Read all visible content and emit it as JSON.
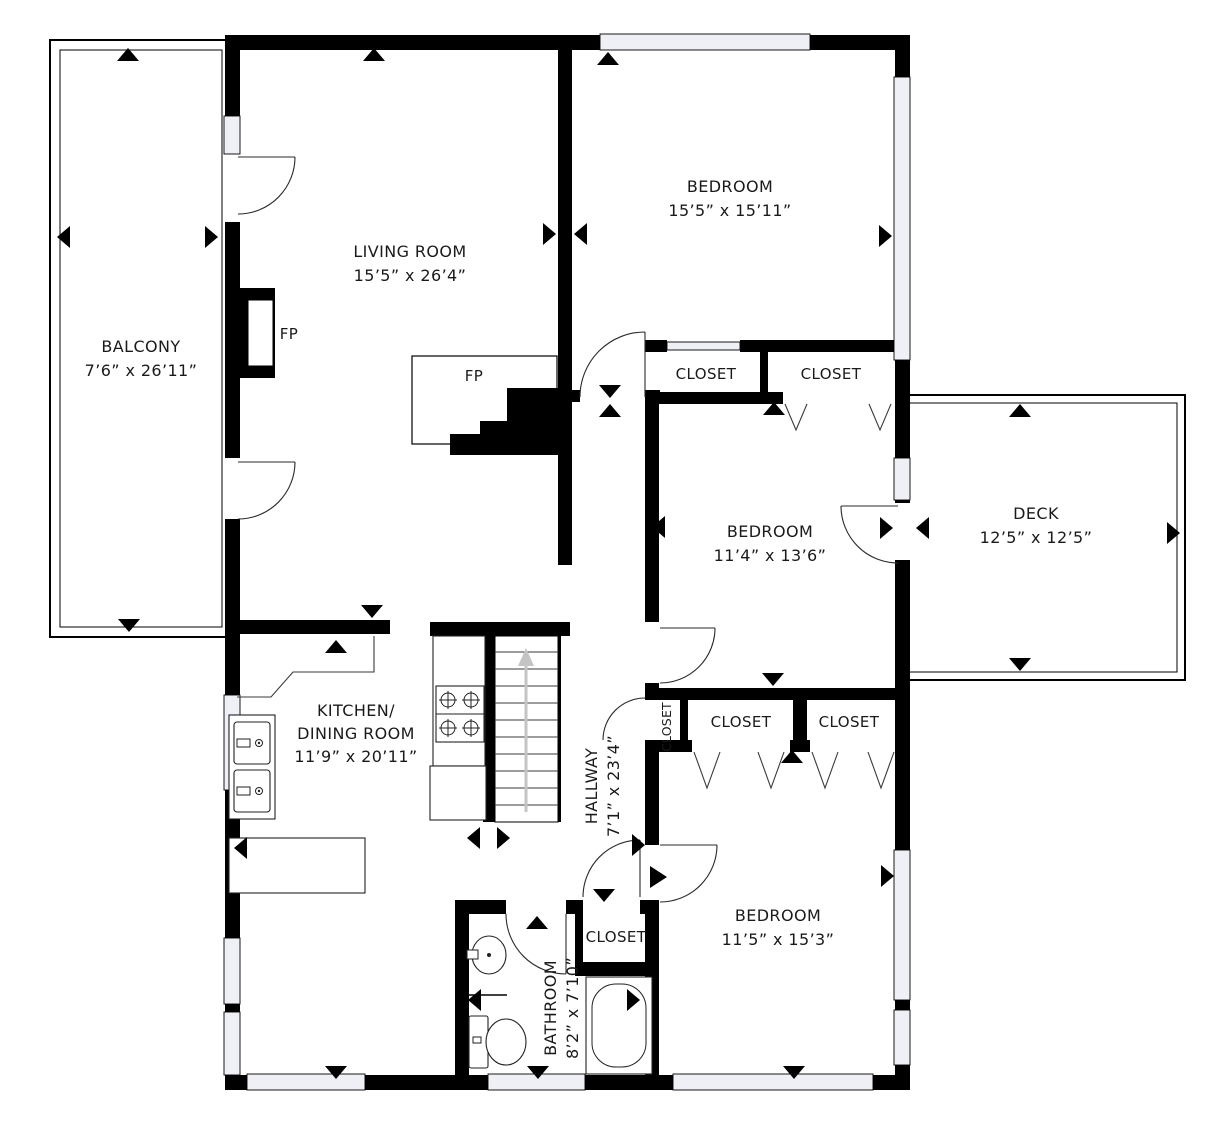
{
  "plan": {
    "rooms": {
      "balcony": {
        "name": "BALCONY",
        "dims": "7’6” x 26’11”"
      },
      "living_room": {
        "name": "LIVING ROOM",
        "dims": "15’5” x 26’4”"
      },
      "bedroom_top": {
        "name": "BEDROOM",
        "dims": "15’5” x 15’11”"
      },
      "bedroom_middle": {
        "name": "BEDROOM",
        "dims": "11’4” x 13’6”"
      },
      "bedroom_bottom": {
        "name": "BEDROOM",
        "dims": "11’5” x 15’3”"
      },
      "deck": {
        "name": "DECK",
        "dims": "12’5” x 12’5”"
      },
      "kitchen": {
        "name_line1": "KITCHEN/",
        "name_line2": "DINING ROOM",
        "dims": "11’9” x 20’11”"
      },
      "hallway": {
        "name": "HALLWAY",
        "dims": "7’1” x 23’4”"
      },
      "bathroom": {
        "name": "BATHROOM",
        "dims": "8’2” x 7’10”"
      }
    },
    "closets": {
      "upper_left": "CLOSET",
      "upper_right": "CLOSET",
      "hall_small": "CLOSET",
      "lower_left": "CLOSET",
      "lower_right": "CLOSET",
      "bathroom": "CLOSET"
    },
    "fireplaces": {
      "left": "FP",
      "center": "FP"
    },
    "colors": {
      "wall": "#000000",
      "background": "#ffffff",
      "window_fill": "#eef0f6",
      "stair_arrow": "#c4c4c4",
      "text": "#1a1a1a"
    }
  }
}
